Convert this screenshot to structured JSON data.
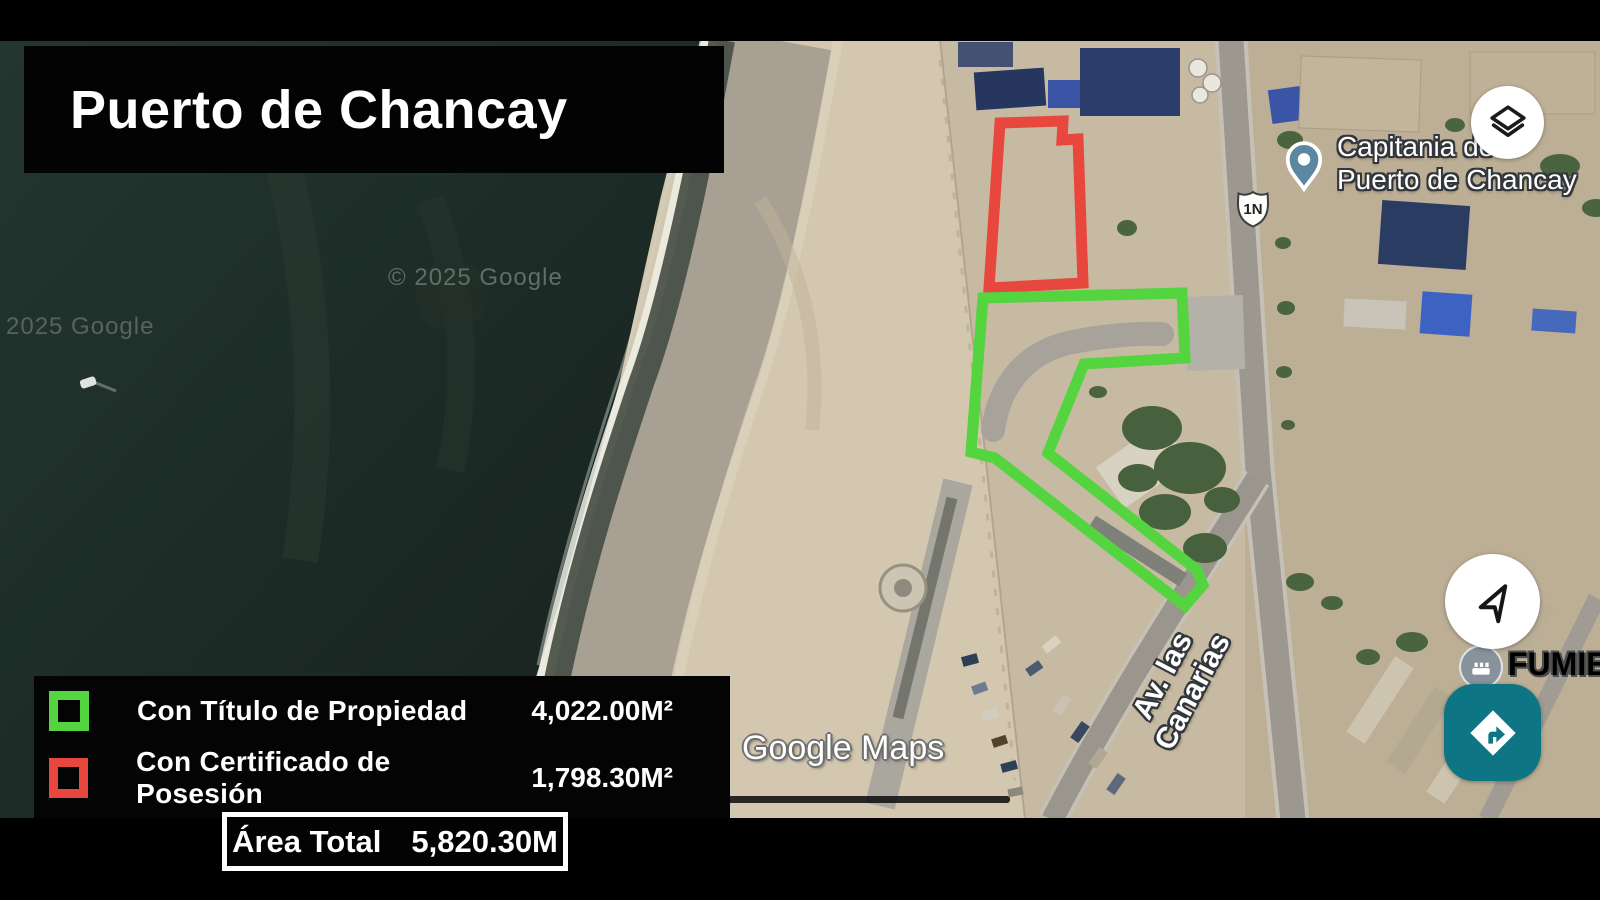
{
  "title": "Puerto de Chancay",
  "legend": {
    "items": [
      {
        "label": "Con Título de Propiedad",
        "value": "4,022.00M²",
        "color": "#54d43e"
      },
      {
        "label": "Con Certificado de Posesión",
        "value": "1,798.30M²",
        "color": "#e8473d"
      }
    ],
    "total_label": "Área Total",
    "total_value": "5,820.30M"
  },
  "map": {
    "brand_watermark": "Google Maps",
    "copyright_center": "© 2025 Google",
    "copyright_left": "2025 Google",
    "poi_capitania": {
      "line1": "Capitania de",
      "line2": "Puerto de Chancay"
    },
    "poi_fumiex": "FUMIEX",
    "street_label": "Av. las Canarias",
    "route_shield": "1N",
    "controls": {
      "layers_icon": "layers",
      "compass_icon": "navigation-arrow",
      "directions_icon": "turn-right-diamond"
    },
    "overlay_colors": {
      "titled_parcel": "#54d43e",
      "possession_parcel": "#e8473d",
      "directions_button": "#0e7585",
      "ocean": "#1d2b26",
      "sand": "#d3c7af"
    }
  }
}
